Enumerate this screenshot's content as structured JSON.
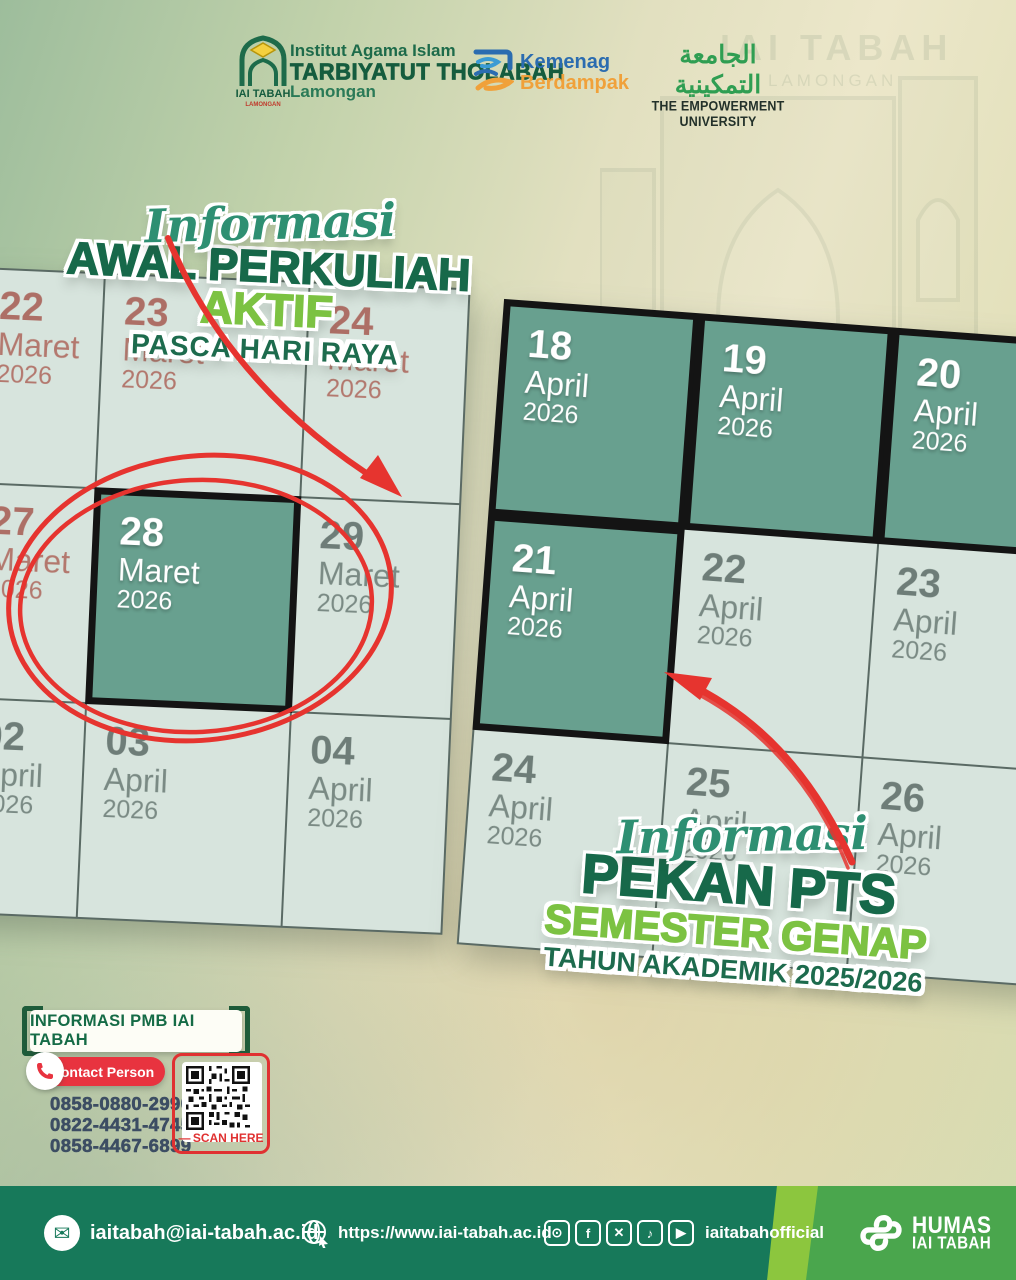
{
  "header": {
    "institution": {
      "logo_label": "IAI TABAH",
      "logo_sublabel": "LAMONGAN",
      "line1": "Institut Agama Islam",
      "line2": "TARBIYATUT THOLABAH",
      "line3": "Lamongan"
    },
    "kemenag": {
      "line1": "Kemenag",
      "line2": "Berdampak"
    },
    "empowerment": {
      "arabic": "الجامعة التمكينية",
      "english": "THE EMPOWERMENT UNIVERSITY"
    }
  },
  "background_building": {
    "sign_top1": "IAI TABAH",
    "sign_top2": "LAMONGAN"
  },
  "left_section": {
    "script": "Informasi",
    "title1": "AWAL PERKULIAH",
    "title2": "AKTIF",
    "subtitle": "PASCA HARI RAYA"
  },
  "right_section": {
    "script": "Informasi",
    "title1": "PEKAN PTS",
    "title2": "SEMESTER GENAP",
    "subtitle": "TAHUN AKADEMIK 2025/2026"
  },
  "left_calendar": {
    "cells": [
      {
        "day": "22",
        "month": "Maret",
        "year": "2026",
        "style": "muted-red"
      },
      {
        "day": "23",
        "month": "Maret",
        "year": "2026",
        "style": "muted-red"
      },
      {
        "day": "24",
        "month": "Maret",
        "year": "2026",
        "style": "muted-red"
      },
      {
        "day": "27",
        "month": "Maret",
        "year": "2026",
        "style": "muted-red"
      },
      {
        "day": "28",
        "month": "Maret",
        "year": "2026",
        "style": "highlight"
      },
      {
        "day": "29",
        "month": "Maret",
        "year": "2026",
        "style": "muted-gray"
      },
      {
        "day": "02",
        "month": "April",
        "year": "2026",
        "style": "muted-gray"
      },
      {
        "day": "03",
        "month": "April",
        "year": "2026",
        "style": "muted-gray"
      },
      {
        "day": "04",
        "month": "April",
        "year": "2026",
        "style": "muted-gray"
      }
    ]
  },
  "right_calendar": {
    "cells": [
      {
        "day": "18",
        "month": "April",
        "year": "2026",
        "style": "highlight"
      },
      {
        "day": "19",
        "month": "April",
        "year": "2026",
        "style": "highlight"
      },
      {
        "day": "20",
        "month": "April",
        "year": "2026",
        "style": "highlight"
      },
      {
        "day": "21",
        "month": "April",
        "year": "2026",
        "style": "highlight"
      },
      {
        "day": "22",
        "month": "April",
        "year": "2026",
        "style": "muted-gray"
      },
      {
        "day": "23",
        "month": "April",
        "year": "2026",
        "style": "muted-gray"
      },
      {
        "day": "24",
        "month": "April",
        "year": "2026",
        "style": "muted-gray"
      },
      {
        "day": "25",
        "month": "April",
        "year": "2026",
        "style": "muted-gray"
      },
      {
        "day": "26",
        "month": "April",
        "year": "2026",
        "style": "muted-gray"
      }
    ]
  },
  "info": {
    "label": "INFORMASI PMB IAI TABAH",
    "contact_label": "Contact Person",
    "phones": [
      "0858-0880-2990",
      "0822-4431-4745",
      "0858-4467-6899"
    ],
    "scan_label": "SCAN HERE"
  },
  "footer": {
    "email": "iaitabah@iai-tabah.ac.id",
    "website": "https://www.iai-tabah.ac.id",
    "social_icons": [
      "instagram-icon",
      "facebook-icon",
      "x-icon",
      "tiktok-icon",
      "youtube-icon"
    ],
    "social_handle": "iaitabahofficial",
    "humas_line1": "HUMAS",
    "humas_line2": "IAI TABAH"
  },
  "colors": {
    "dark_green": "#17694a",
    "light_green": "#7cc242",
    "script_teal": "#2e8f72",
    "annotation_red": "#e6342f",
    "highlight_cell": "#68a08f",
    "light_cell": "#d7e4dd",
    "muted_red_text": "#b3786e",
    "muted_gray_text": "#7a8a84",
    "phone_text": "#3c4d63",
    "footer_dark_green": "#17795a",
    "footer_stripe_green": "#8cc63e",
    "footer_right_green": "#4aa64d",
    "kemenag_blue": "#2b6cb0",
    "kemenag_orange": "#f0a13a"
  }
}
